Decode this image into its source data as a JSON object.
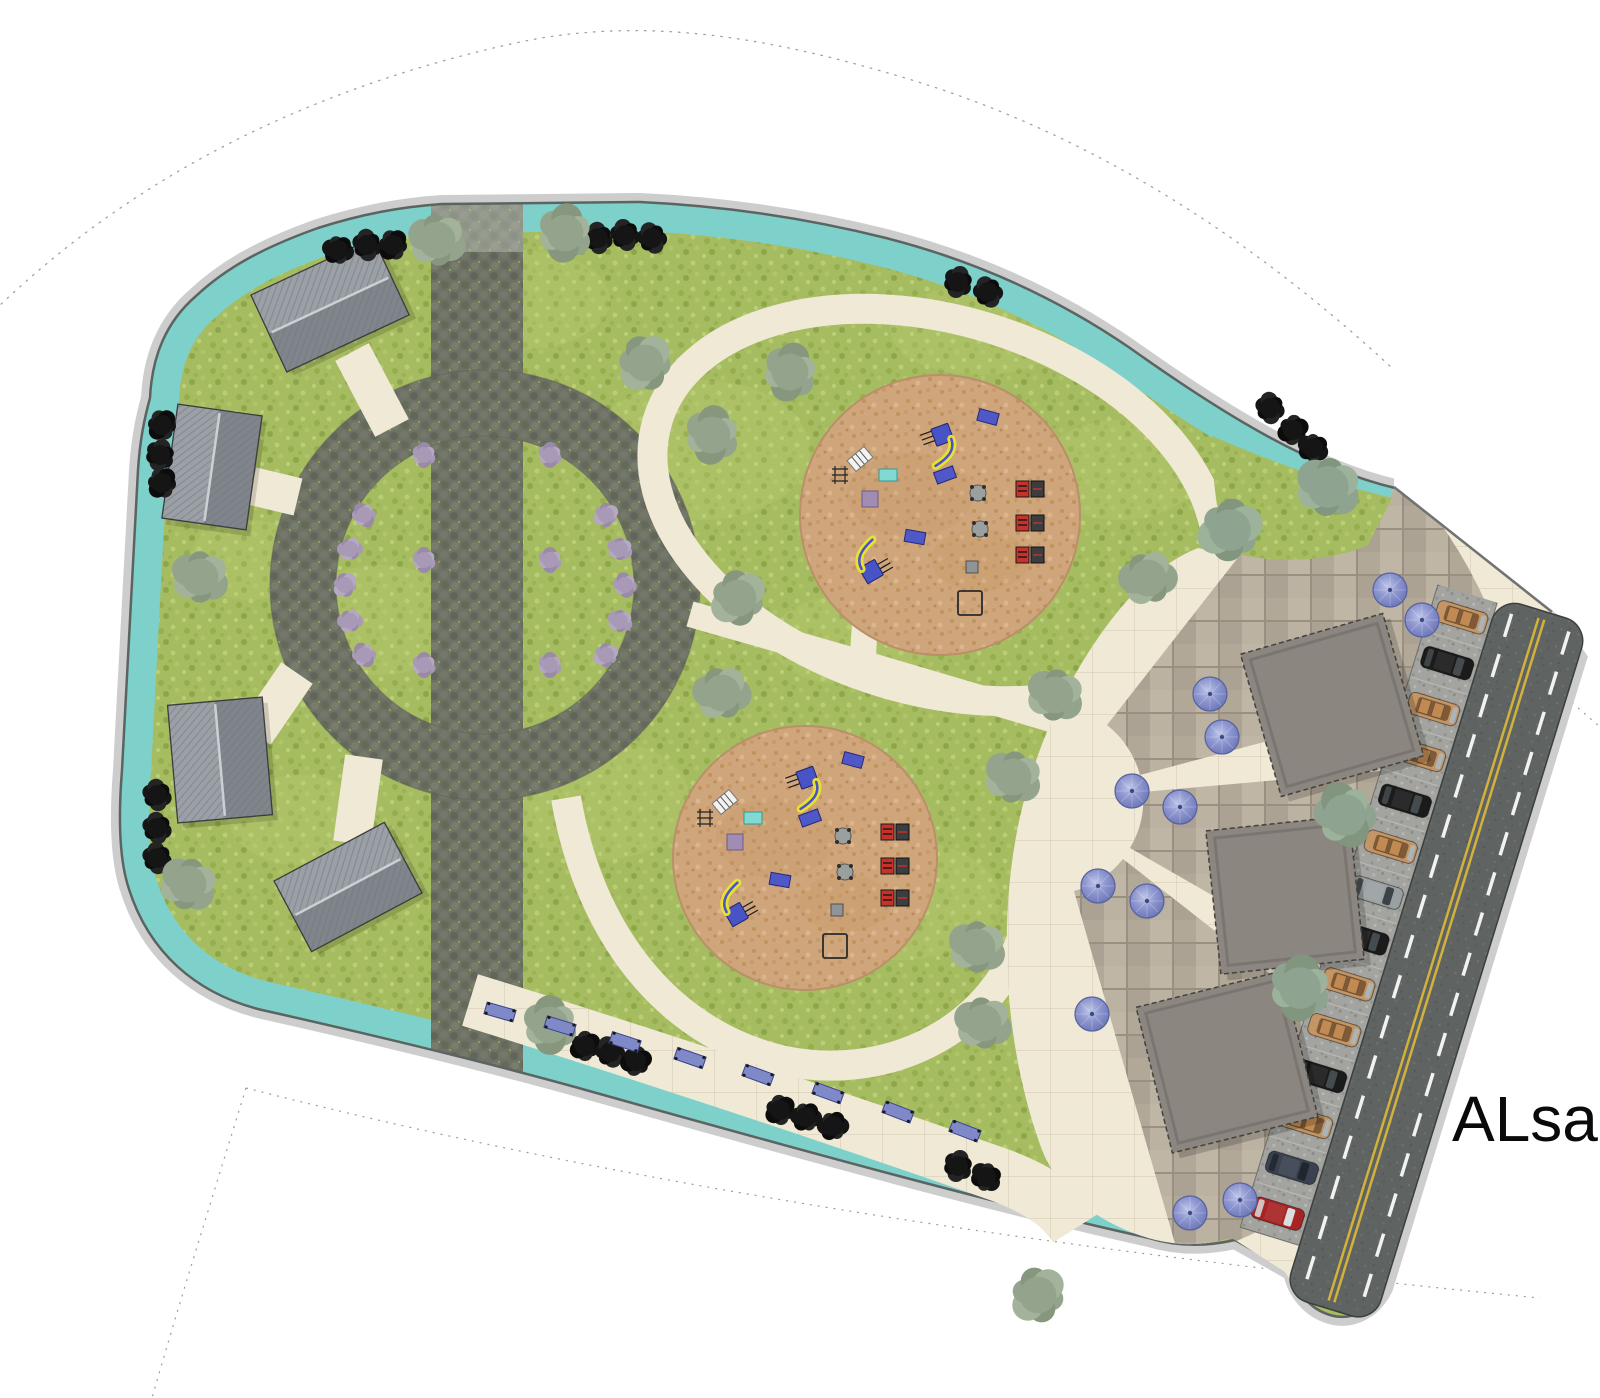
{
  "labels": {
    "street": "ALsah"
  },
  "palette": {
    "grass": "#a6bc60",
    "teal_border": "#7ed1cb",
    "outline": "#5c6462",
    "cobble": "#6e7265",
    "cream_path": "#efe9d6",
    "sand": "#cfa57b",
    "paver": "#b8ae9e",
    "asphalt": "#5f6361",
    "parking": "#a3a39f",
    "road_yellow": "#d2b13c",
    "road_white": "#f2f2ee",
    "umbrella": "#8a93cc",
    "building": "#8b8680",
    "pavilion_roof": "#8f959b",
    "bench_blue": "#8089c8",
    "slide_yellow": "#e8e032",
    "slide_blue": "#4853c6",
    "bbq_red": "#c8302a",
    "shrub_purple": "#a89ab6",
    "tree_black": "#151515",
    "tree_olive": "#94a48c"
  },
  "park": {
    "black_trees": [
      [
        338,
        250
      ],
      [
        367,
        245
      ],
      [
        393,
        245
      ],
      [
        598,
        238
      ],
      [
        625,
        235
      ],
      [
        652,
        238
      ],
      [
        958,
        282
      ],
      [
        988,
        292
      ],
      [
        1270,
        408
      ],
      [
        1293,
        430
      ],
      [
        1313,
        448
      ],
      [
        162,
        425
      ],
      [
        160,
        455
      ],
      [
        162,
        483
      ],
      [
        157,
        795
      ],
      [
        157,
        828
      ],
      [
        157,
        858
      ],
      [
        585,
        1046
      ],
      [
        610,
        1052
      ],
      [
        636,
        1061
      ],
      [
        780,
        1110
      ],
      [
        806,
        1117
      ],
      [
        833,
        1126
      ],
      [
        958,
        1166
      ],
      [
        986,
        1177
      ]
    ],
    "olive_trees": [
      [
        437,
        240
      ],
      [
        565,
        233
      ],
      [
        200,
        577
      ],
      [
        645,
        363
      ],
      [
        712,
        435
      ],
      [
        790,
        372
      ],
      [
        738,
        598
      ],
      [
        722,
        693
      ],
      [
        188,
        884
      ],
      [
        550,
        1025
      ],
      [
        977,
        947
      ],
      [
        983,
        1023
      ],
      [
        1038,
        1295
      ],
      [
        1013,
        777
      ],
      [
        1055,
        695
      ],
      [
        1148,
        578
      ]
    ],
    "plaza_shrubs": [
      [
        1230,
        530
      ],
      [
        1328,
        487
      ],
      [
        1345,
        815
      ],
      [
        1300,
        988
      ]
    ],
    "purple_shrubs": [
      [
        364,
        655
      ],
      [
        350,
        621
      ],
      [
        345,
        585
      ],
      [
        350,
        549
      ],
      [
        364,
        515
      ],
      [
        606,
        515
      ],
      [
        620,
        549
      ],
      [
        625,
        585
      ],
      [
        620,
        621
      ],
      [
        606,
        655
      ],
      [
        424,
        455
      ],
      [
        424,
        560
      ],
      [
        424,
        665
      ],
      [
        550,
        455
      ],
      [
        550,
        560
      ],
      [
        550,
        665
      ]
    ],
    "pavilions": [
      {
        "x": 330,
        "y": 305,
        "w": 135,
        "h": 85,
        "rot": -25
      },
      {
        "x": 212,
        "y": 467,
        "w": 85,
        "h": 115,
        "rot": 8
      },
      {
        "x": 220,
        "y": 760,
        "w": 95,
        "h": 118,
        "rot": -5
      },
      {
        "x": 348,
        "y": 887,
        "w": 125,
        "h": 80,
        "rot": -28
      }
    ],
    "playgrounds": [
      {
        "cx": 940,
        "cy": 515,
        "r": 140
      },
      {
        "cx": 805,
        "cy": 858,
        "r": 132
      }
    ],
    "equipment": [
      {
        "type": "slide",
        "dx": 0,
        "dy": -72,
        "rot": -20
      },
      {
        "type": "pg_bench",
        "dx": 48,
        "dy": -98,
        "rot": 15
      },
      {
        "type": "pg_bench",
        "dx": 5,
        "dy": -40,
        "rot": -20
      },
      {
        "type": "seesaw",
        "dx": -80,
        "dy": -56,
        "rot": -40
      },
      {
        "type": "teal_table",
        "dx": -52,
        "dy": -40,
        "rot": 0
      },
      {
        "type": "purple_mat",
        "dx": -70,
        "dy": -16,
        "rot": 0
      },
      {
        "type": "climb_frame",
        "dx": -100,
        "dy": -40,
        "rot": 0
      },
      {
        "type": "slide",
        "dx": -68,
        "dy": 48,
        "rot": 150
      },
      {
        "type": "pg_bench",
        "dx": -25,
        "dy": 22,
        "rot": 10
      },
      {
        "type": "spring",
        "dx": 38,
        "dy": -22,
        "rot": 0
      },
      {
        "type": "spring",
        "dx": 40,
        "dy": 14,
        "rot": 0
      },
      {
        "type": "bbq",
        "dx": 90,
        "dy": -26,
        "rot": 0
      },
      {
        "type": "bbq",
        "dx": 90,
        "dy": 8,
        "rot": 0
      },
      {
        "type": "bbq",
        "dx": 90,
        "dy": 40,
        "rot": 0
      },
      {
        "type": "gray_box",
        "dx": 32,
        "dy": 52,
        "rot": 0
      },
      {
        "type": "play_frame",
        "dx": 30,
        "dy": 88,
        "rot": 0
      }
    ],
    "benches": [
      [
        500,
        1012,
        16
      ],
      [
        560,
        1026,
        17
      ],
      [
        625,
        1042,
        18
      ],
      [
        690,
        1058,
        19
      ],
      [
        758,
        1075,
        20
      ],
      [
        828,
        1093,
        20
      ],
      [
        898,
        1112,
        21
      ],
      [
        965,
        1131,
        21
      ]
    ]
  },
  "plaza": {
    "buildings": [
      {
        "x": 1332,
        "y": 705,
        "size": 148,
        "rot": -16
      },
      {
        "x": 1285,
        "y": 895,
        "size": 144,
        "rot": -6
      },
      {
        "x": 1227,
        "y": 1062,
        "size": 150,
        "rot": -14
      }
    ],
    "umbrellas": [
      [
        1390,
        590
      ],
      [
        1422,
        620
      ],
      [
        1210,
        694
      ],
      [
        1222,
        737
      ],
      [
        1132,
        791
      ],
      [
        1180,
        807
      ],
      [
        1098,
        886
      ],
      [
        1147,
        901
      ],
      [
        1092,
        1014
      ],
      [
        1190,
        1213
      ],
      [
        1240,
        1200
      ]
    ]
  },
  "street": {
    "cars": [
      "tan",
      "black",
      "tan",
      "tan",
      "black",
      "tan",
      "gray",
      "black",
      "tan",
      "tan",
      "black",
      "tan",
      "darkblue",
      "red"
    ]
  }
}
